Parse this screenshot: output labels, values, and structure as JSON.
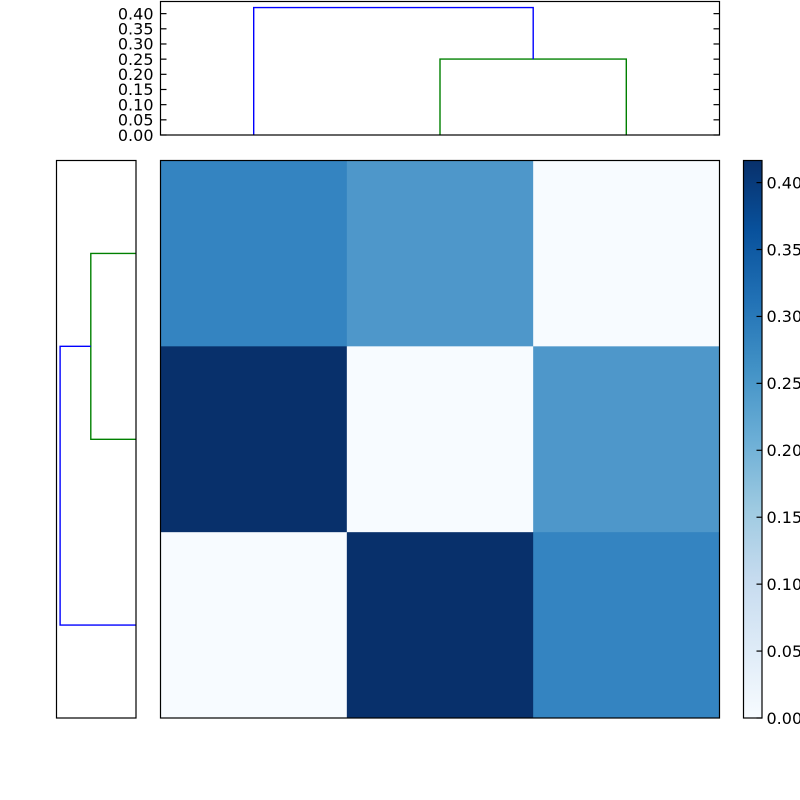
{
  "figure": {
    "background_color": "#ffffff",
    "description": "Hierarchically clustered distance matrix heatmap with row and column dendrograms and a colorbar"
  },
  "chart_data": {
    "type": "heatmap",
    "title": "",
    "xlabel": "",
    "ylabel": "",
    "grid": false,
    "colormap_name": "Blues",
    "value_range": {
      "vmin": 0.0,
      "vmax": 0.4165
    },
    "matrix": {
      "rows": 3,
      "cols": 3,
      "values": [
        [
          0.28,
          0.25,
          0.0
        ],
        [
          0.42,
          0.0,
          0.25
        ],
        [
          0.0,
          0.42,
          0.28
        ]
      ],
      "cell_colors": [
        [
          "#3484c1",
          "#4e97ca",
          "#f7fbff"
        ],
        [
          "#08306b",
          "#f7fbff",
          "#4e97ca"
        ],
        [
          "#f7fbff",
          "#08306b",
          "#3484c1"
        ]
      ]
    },
    "top_dendrogram": {
      "orientation": "top",
      "axis_max": 0.44,
      "axis_tick_labels": [
        "0.40",
        "0.35",
        "0.30",
        "0.25",
        "0.20",
        "0.15",
        "0.10",
        "0.05",
        "0.00"
      ],
      "axis_tick_values": [
        0.4,
        0.35,
        0.3,
        0.25,
        0.2,
        0.15,
        0.1,
        0.05,
        0.0
      ],
      "merge_heights": [
        0.25,
        0.42
      ],
      "links": [
        {
          "color": "#008000",
          "points": [
            [
              0.5,
              0.0
            ],
            [
              0.5,
              0.25
            ],
            [
              0.8333,
              0.25
            ],
            [
              0.8333,
              0.0
            ]
          ]
        },
        {
          "color": "#0000ff",
          "points": [
            [
              0.1667,
              0.0
            ],
            [
              0.1667,
              0.42
            ],
            [
              0.6667,
              0.42
            ],
            [
              0.6667,
              0.25
            ]
          ]
        }
      ]
    },
    "left_dendrogram": {
      "orientation": "left",
      "axis_max": 0.44,
      "merge_heights": [
        0.25,
        0.42
      ],
      "links": [
        {
          "color": "#008000",
          "points": [
            [
              0.0,
              0.1667
            ],
            [
              0.25,
              0.1667
            ],
            [
              0.25,
              0.5
            ],
            [
              0.0,
              0.5
            ]
          ]
        },
        {
          "color": "#0000ff",
          "points": [
            [
              0.0,
              0.8333
            ],
            [
              0.42,
              0.8333
            ],
            [
              0.42,
              0.3333
            ],
            [
              0.25,
              0.3333
            ]
          ]
        }
      ]
    },
    "colorbar": {
      "position": "right",
      "tick_labels": [
        "0.40",
        "0.35",
        "0.30",
        "0.25",
        "0.20",
        "0.15",
        "0.10",
        "0.05",
        "0.00"
      ],
      "tick_values": [
        0.4,
        0.35,
        0.3,
        0.25,
        0.2,
        0.15,
        0.1,
        0.05,
        0.0
      ],
      "gradient_stops": [
        {
          "pos": 0.0,
          "color": "#f7fbff"
        },
        {
          "pos": 0.125,
          "color": "#deebf7"
        },
        {
          "pos": 0.25,
          "color": "#c6dbef"
        },
        {
          "pos": 0.375,
          "color": "#9ecae1"
        },
        {
          "pos": 0.5,
          "color": "#6baed6"
        },
        {
          "pos": 0.625,
          "color": "#4292c6"
        },
        {
          "pos": 0.75,
          "color": "#2171b5"
        },
        {
          "pos": 0.875,
          "color": "#08519c"
        },
        {
          "pos": 1.0,
          "color": "#08306b"
        }
      ]
    },
    "link_colors": {
      "below_threshold": "#008000",
      "above_threshold": "#0000ff"
    },
    "frame_color": "#000000"
  }
}
